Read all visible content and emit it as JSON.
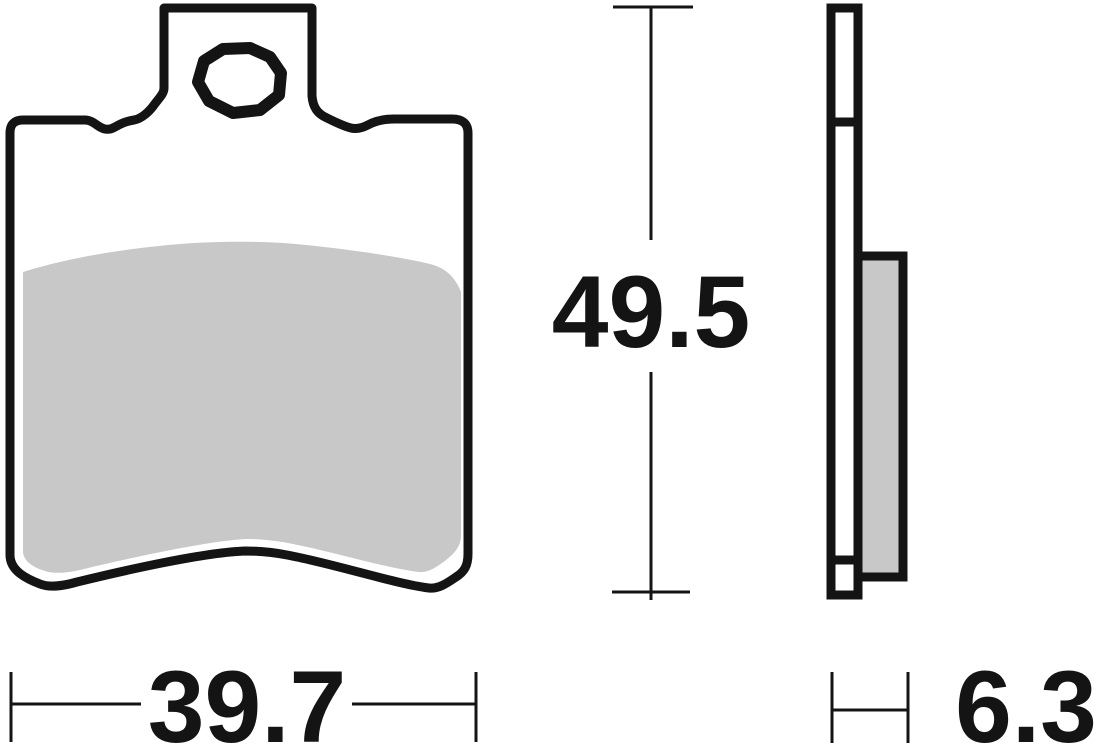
{
  "drawing": {
    "subject": "brake-pad-technical-drawing",
    "views": {
      "front": "front-view",
      "side": "side-profile-view"
    },
    "colors": {
      "line": "#141414",
      "friction_material": "#c8c8c8",
      "background": "#ffffff"
    },
    "dimensions": {
      "height": {
        "value": "49.5"
      },
      "width": {
        "value": "39.7"
      },
      "thickness": {
        "value": "6.3"
      }
    }
  }
}
